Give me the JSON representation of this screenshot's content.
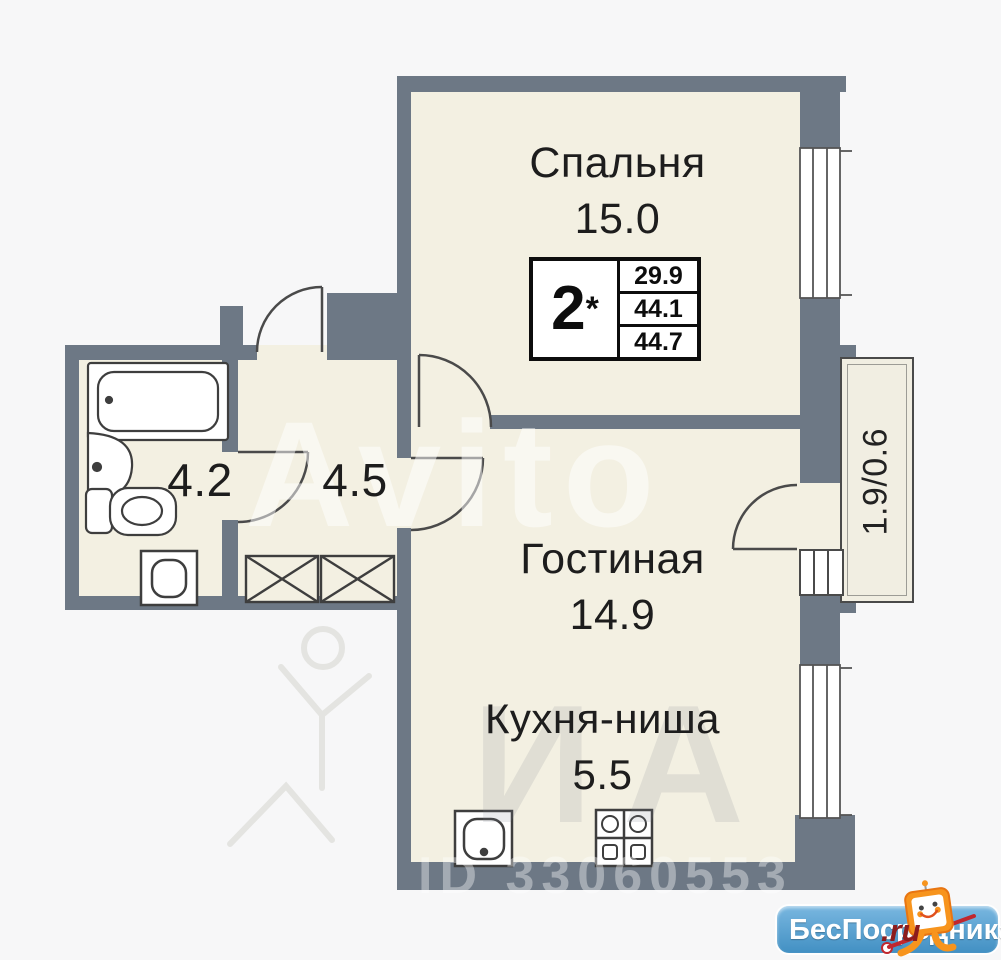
{
  "plan": {
    "rooms": [
      {
        "id": "bedroom",
        "label": "Спальня",
        "area": "15.0"
      },
      {
        "id": "living",
        "label": "Гостиная",
        "area": "14.9"
      },
      {
        "id": "kitchen",
        "label": "Кухня-ниша",
        "area": "5.5"
      },
      {
        "id": "bathroom",
        "label": "",
        "area": "4.2"
      },
      {
        "id": "hallway",
        "label": "",
        "area": "4.5"
      },
      {
        "id": "balcony",
        "label": "",
        "area": "1.9/0.6"
      }
    ],
    "info_box": {
      "rooms_count": "2",
      "star": "*",
      "values": [
        "29.9",
        "44.1",
        "44.7"
      ]
    },
    "fixtures": [
      "bathtub",
      "sink",
      "toilet",
      "washing-machine",
      "wardrobe",
      "wardrobe",
      "kitchen-sink",
      "stove"
    ]
  },
  "watermarks": {
    "brand": "Avito",
    "letters": "ИА",
    "id_label": "ID 33060553"
  },
  "footer_logo": {
    "name": "БесПосредника",
    "tld": ".ru"
  },
  "colors": {
    "wall": "#6d7885",
    "floor": "#f3f0e2",
    "background": "#f7f7f8",
    "logo_blue": "#4290c3",
    "logo_orange": "#f7941d",
    "logo_red": "#8c1c1c"
  }
}
